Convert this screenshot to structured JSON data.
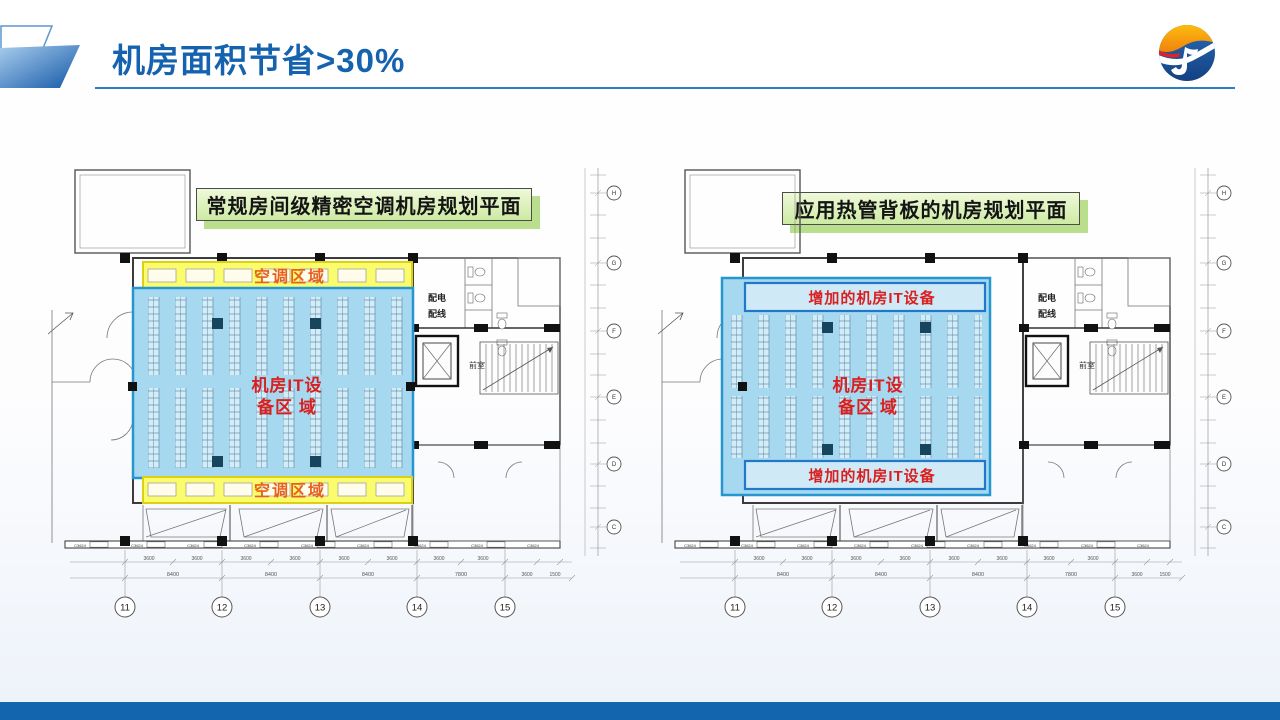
{
  "header": {
    "title": "机房面积节省>30%"
  },
  "colors": {
    "title_blue": "#1563ae",
    "footer_bar_blue": "#1366ad",
    "ac_zone_yellow": "#fbfb6e",
    "it_zone_blue": "#a6d9ef",
    "it_zone_border": "#2596cf",
    "added_box_border": "#1f78c8",
    "red_label": "#d91f1f",
    "orange_label": "#e8611c",
    "callout_green": "#cdeaa4"
  },
  "plans": {
    "shared": {
      "axis_numbers": [
        "11",
        "12",
        "13",
        "14",
        "15"
      ],
      "axis_letters": [
        "H",
        "G",
        "F",
        "E",
        "D",
        "C"
      ],
      "window_label": "C3624",
      "dim_bay": "3600",
      "dim_spans": [
        "8400",
        "8400",
        "8400",
        "7800"
      ],
      "dim_right": [
        "3600",
        "1500"
      ],
      "room_power_line1": "配电",
      "room_power_line2": "配线",
      "room_vestibule": "前室",
      "it_zone_line1": "机房IT设",
      "it_zone_line2": "备区 域"
    },
    "left": {
      "header": "常规房间级精密空调机房规划平面",
      "ac_zone_label": "空调区域"
    },
    "right": {
      "header": "应用热管背板的机房规划平面",
      "added_it_label": "增加的机房IT设备"
    }
  }
}
